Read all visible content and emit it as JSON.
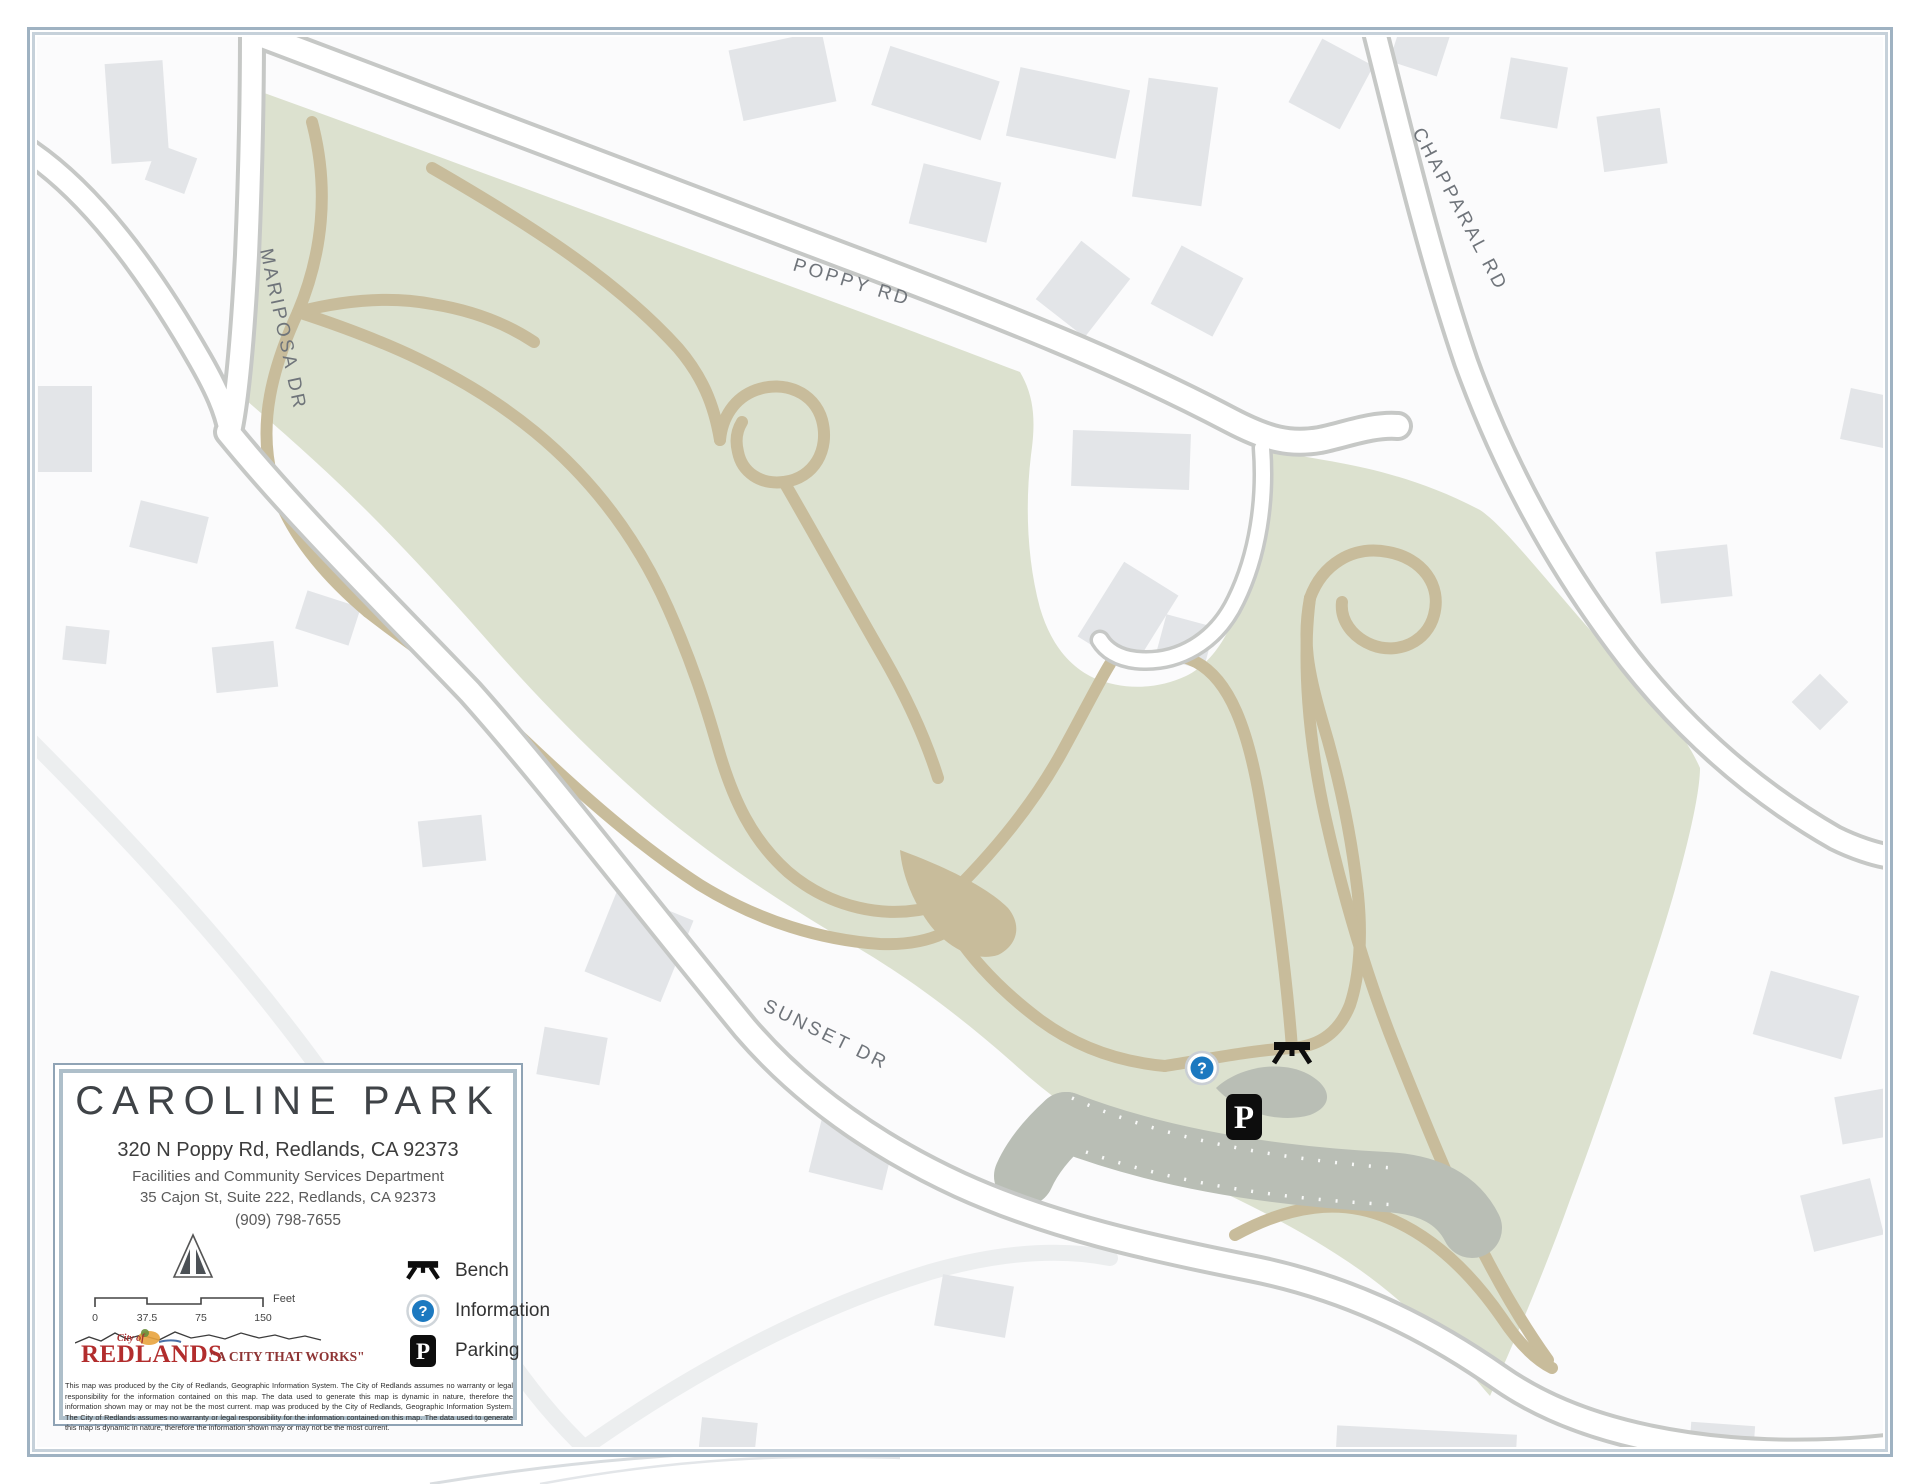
{
  "colors": {
    "park_green": "#dce1cf",
    "trail_tan": "#c8bc9b",
    "road_casing": "#c6c8c6",
    "parking_gray": "#b9beb5",
    "frame_blue": "#9fb2c2",
    "building_gray": "#e3e5e8",
    "info_blue": "#1c79c0",
    "logo_red": "#b22d2d",
    "tagline_red": "#8e3434"
  },
  "map": {
    "road_labels": {
      "mariposa": "MARIPOSA DR",
      "poppy": "POPPY RD",
      "chapparal": "CHAPPARAL RD",
      "sunset": "SUNSET DR"
    },
    "markers": {
      "information_symbol": "?",
      "parking_symbol": "P"
    }
  },
  "title_box": {
    "title": "CAROLINE PARK",
    "address": "320 N Poppy Rd, Redlands, CA 92373",
    "department": "Facilities and Community Services Department",
    "department_address": "35 Cajon St, Suite 222, Redlands, CA 92373",
    "phone": "(909) 798-7655",
    "scale_bar": {
      "tick0": "0",
      "tick1": "37.5",
      "tick2": "75",
      "tick3": "150",
      "unit": "Feet"
    },
    "legend": {
      "items": [
        {
          "icon": "bench-icon",
          "label": "Bench"
        },
        {
          "icon": "information-icon",
          "label": "Information"
        },
        {
          "icon": "parking-icon",
          "label": "Parking"
        }
      ]
    },
    "logo": {
      "prefix": "City of",
      "city": "REDLANDS",
      "tagline": "\"A CITY THAT WORKS\""
    },
    "disclaimer": "This map was produced by the City of Redlands, Geographic Information System. The City of Redlands assumes no warranty or legal responsibility for the information contained on this map. The data used to generate this map is dynamic in nature, therefore the information shown may or may not be the most current. map was produced by the City of Redlands, Geographic Information System. The City of Redlands assumes no warranty or legal responsibility for the information contained on this map. The data used to generate this map is dynamic in nature, therefore the information shown may or may not be the most current."
  }
}
